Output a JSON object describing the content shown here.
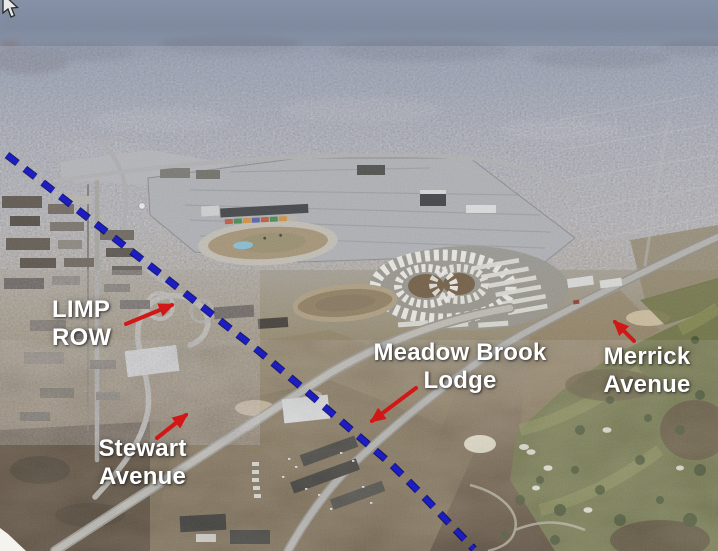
{
  "annotations": {
    "labels": [
      {
        "id": "limp-row",
        "text": "LIMP ROW"
      },
      {
        "id": "stewart-avenue",
        "text": "Stewart Avenue"
      },
      {
        "id": "meadow-brook-lodge",
        "text": "Meadow Brook Lodge"
      },
      {
        "id": "merrick-avenue",
        "text": "Merrick Avenue"
      }
    ],
    "colors": {
      "label_text": "#ffffff",
      "arrow_red": "#d21717",
      "route_line_blue": "#1d1dc4"
    },
    "route_line_style": "blue dashed diagonal line"
  }
}
